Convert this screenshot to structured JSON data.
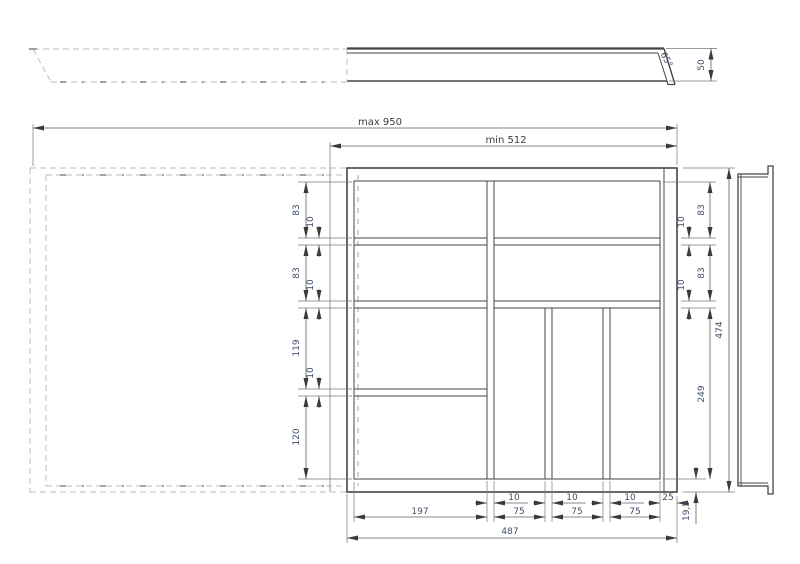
{
  "dims": {
    "max_width": "max 950",
    "min_width": "min 512",
    "side_height": "50",
    "side_angle": "65°",
    "left_83_top": "83",
    "left_10_top": "10",
    "left_83_mid": "83",
    "left_10_mid": "10",
    "left_119": "119",
    "left_10_bot": "10",
    "left_120": "120",
    "right_10_top": "10",
    "right_83_top": "83",
    "right_10_mid": "10",
    "right_83_mid": "83",
    "right_474": "474",
    "right_249": "249",
    "bottom_10_a": "10",
    "bottom_10_b": "10",
    "bottom_10_c": "10",
    "bottom_25": "25",
    "bottom_197": "197",
    "bottom_75_a": "75",
    "bottom_75_b": "75",
    "bottom_75_c": "75",
    "bottom_total": "487",
    "bottom_wall": "19,5"
  },
  "colors": {
    "outline": "#454545",
    "dimension_line": "#5f5f5f",
    "dashed_line": "#bcbcbc",
    "dimension_text": "#3f4e68"
  }
}
